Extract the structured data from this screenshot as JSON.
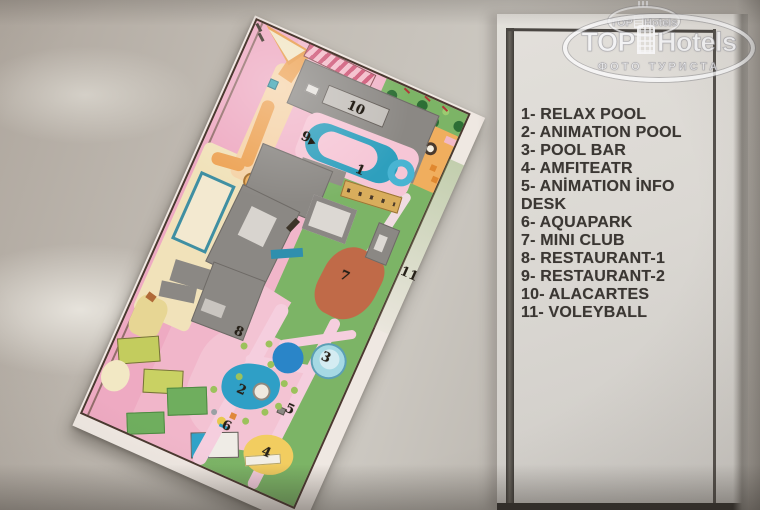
{
  "photo": {
    "description": "Photograph of a hotel resort site plan with numbered legend card",
    "width_px": 760,
    "height_px": 510
  },
  "watermark": {
    "brand_word1": "TOP",
    "brand_word2": "Hotels",
    "subtitle": "ФОТО ТУРИСТА",
    "icon": "building-icon"
  },
  "watermark_small": {
    "brand_word1": "TOP",
    "brand_word2": "Hotels"
  },
  "legend": {
    "lines": [
      "1- RELAX POOL",
      "2- ANIMATION POOL",
      "3- POOL BAR",
      "4- AMFITEATR",
      "5- ANİMATION İNFO",
      "DESK",
      "6- AQUAPARK",
      "7- MINI CLUB",
      "8- RESTAURANT-1",
      "9- RESTAURANT-2",
      "10- ALACARTES",
      "11- VOLEYBALL"
    ]
  },
  "map": {
    "markers": [
      {
        "n": "1",
        "x": 155,
        "y": 95
      },
      {
        "n": "2",
        "x": 136,
        "y": 344
      },
      {
        "n": "3",
        "x": 200,
        "y": 280
      },
      {
        "n": "4",
        "x": 184,
        "y": 391
      },
      {
        "n": "5",
        "x": 188,
        "y": 342
      },
      {
        "n": "6",
        "x": 137,
        "y": 383
      },
      {
        "n": "7",
        "x": 184,
        "y": 198
      },
      {
        "n": "8",
        "x": 110,
        "y": 292
      },
      {
        "n": "9",
        "x": 92,
        "y": 87,
        "arrow": true
      },
      {
        "n": "10",
        "x": 126,
        "y": 40
      }
    ],
    "outside_marker": {
      "n": "11",
      "x": 246,
      "y": 174
    },
    "palette": {
      "pink_base": "#f1b6ca",
      "pool_blue": "#2e9fbd",
      "grass_green": "#7cb466",
      "building_gray": "#8b8884",
      "path_orange": "#efa355",
      "terracotta": "#c06a48",
      "amphitheater_yellow": "#f2cd60",
      "court_khaki": "#c3cc5e",
      "border_brown": "#4a3a30"
    }
  }
}
